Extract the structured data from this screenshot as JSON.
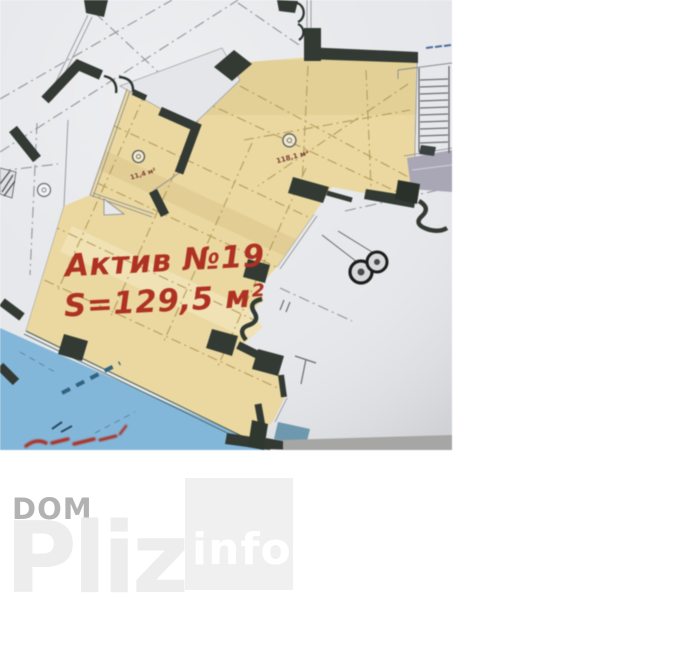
{
  "photo": {
    "asset_label": {
      "title": "Актив №19",
      "area": "S=129,5 м²"
    },
    "rooms": [
      {
        "area": "11,4 м²"
      },
      {
        "area": "118,1 м²"
      }
    ],
    "colors": {
      "highlight": "#e9d8a2",
      "pool_blue": "#84b7d8",
      "wall": "#333a34",
      "paper": "#e7e8eb",
      "lavender": "#a9a6b6",
      "label_red": "#ac3224"
    }
  },
  "watermark": {
    "top": "DOM",
    "main": "Pliz",
    "badge": "info",
    "colors": {
      "top": "#b2b2b2",
      "main": "#ededed",
      "badge_bg": "#f0f0f1",
      "badge_text": "#ffffff"
    }
  }
}
